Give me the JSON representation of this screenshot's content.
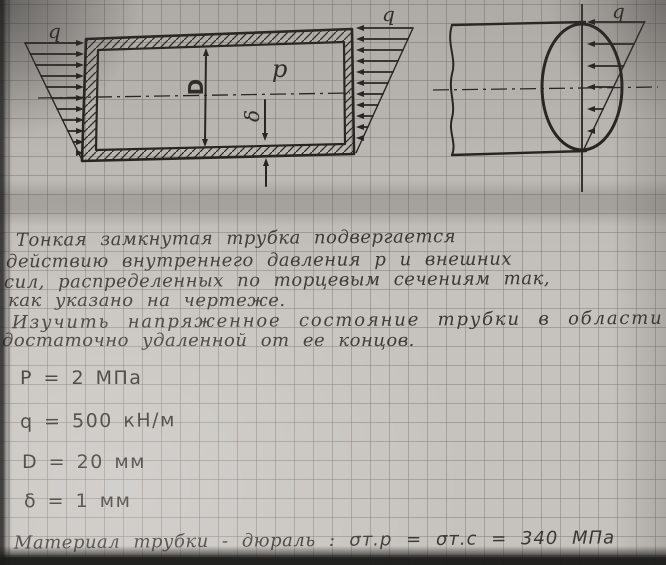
{
  "figure": {
    "front_view": {
      "load_label_left": "q",
      "load_label_right": "q",
      "pressure_label": "p",
      "diameter_label": "D",
      "thickness_label": "δ"
    },
    "side_view": {
      "load_label": "q"
    }
  },
  "problem": {
    "statement_lines": [
      "Тонкая замкнутая трубка подвергается",
      "действию внутреннего давления p и внешних",
      "сил, распределенных по торцевым сечениям так,",
      "как указано на чертеже.",
      "Изучить напряженное состояние трубки в области",
      "достаточно удаленной от ее концов."
    ]
  },
  "given": {
    "items": [
      {
        "name": "pressure",
        "text": "P = 2 МПа"
      },
      {
        "name": "end-load",
        "text": "q = 500 кН/м"
      },
      {
        "name": "diameter",
        "text": "D = 20 мм"
      },
      {
        "name": "wall-thickness",
        "text": "δ = 1 мм"
      }
    ]
  },
  "material": {
    "prose": "Материал трубки - дюраль :",
    "yield_equation": "σт.р = σт.с = 340 МПа"
  },
  "colors": {
    "paper": "#c6c3be",
    "grid_line": "#787570",
    "ink": "#23211e",
    "pencil": "#3b3733"
  }
}
